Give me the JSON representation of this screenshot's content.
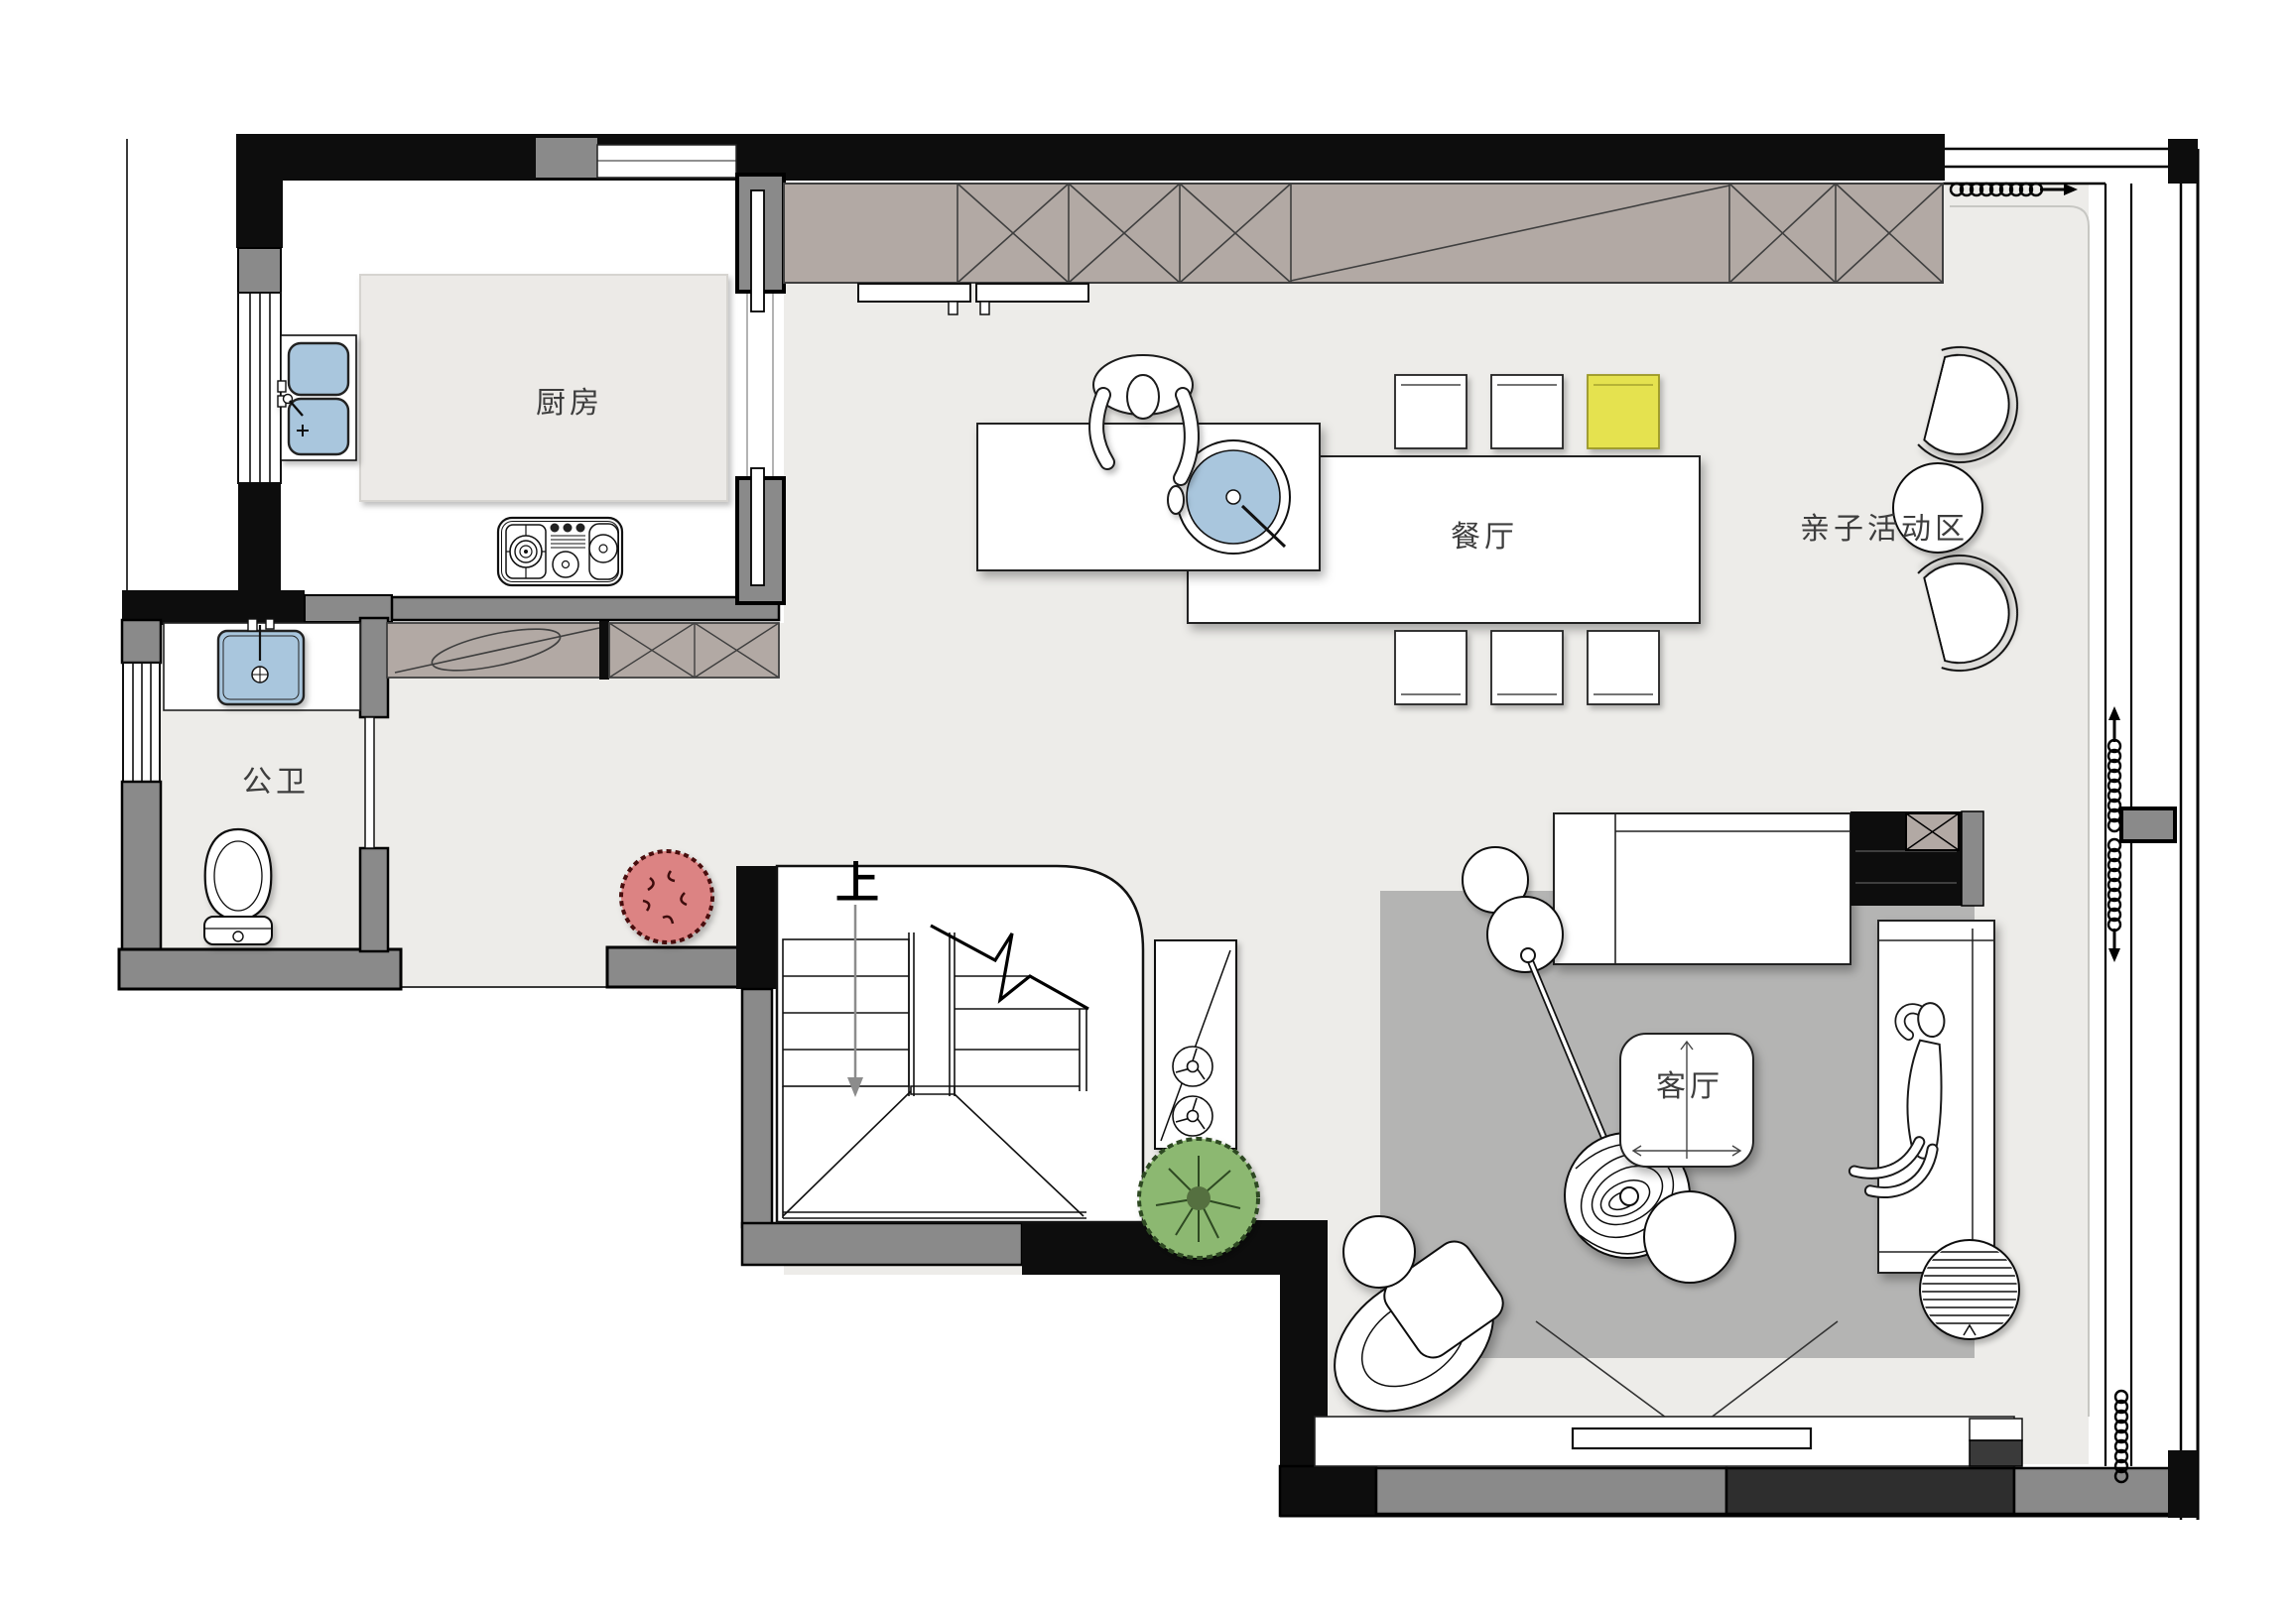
{
  "plan": {
    "type": "residential-floor-plan",
    "floor_hint": "ground floor with staircase going up"
  },
  "rooms": {
    "kitchen": {
      "label": "厨房"
    },
    "bathroom": {
      "label": "公卫"
    },
    "dining": {
      "label": "餐厅"
    },
    "activity": {
      "label": "亲子活动区"
    },
    "living": {
      "label": "客厅"
    },
    "stairs": {
      "up_label": "上"
    }
  },
  "colors": {
    "wall_black": "#0d0d0d",
    "wall_gray": "#8a8a8a",
    "wall_dark": "#2e2e2e",
    "floor": "#edece9",
    "floor_edge": "#c7c7c3",
    "cabinet_fill": "#b2a9a4",
    "cabinet_line": "#3f3f3f",
    "rug": "#b4b4b3",
    "water_blue": "#a9c6dd",
    "chair_yellow": "#e5e24f",
    "plant_red": "#dc8383",
    "plant_green": "#8cb871",
    "line": "#1b1b1b",
    "arrow_gray": "#8c8c8c"
  },
  "symbols": [
    "kitchen-sink-icon",
    "stove-icon",
    "bathroom-sink-icon",
    "toilet-icon",
    "island-sink-icon",
    "dining-table",
    "dining-chair",
    "yellow-dining-chair",
    "shell-chair",
    "round-table",
    "stair-run",
    "stair-direction-arrow",
    "break-line",
    "fan-icon",
    "curtain-coil-icon",
    "sliding-door",
    "wardrobe-x-cabinet",
    "hanging-rod-cabinet",
    "window",
    "daybed",
    "fireplace-cabinet",
    "sofa",
    "coffee-table",
    "floor-lamp",
    "decor-ball",
    "pouf",
    "striped-pouf",
    "armchair",
    "rug",
    "tv-panel",
    "tv-console",
    "red-plant-icon",
    "green-plant-icon",
    "person-standing-icon",
    "person-lying-icon"
  ]
}
